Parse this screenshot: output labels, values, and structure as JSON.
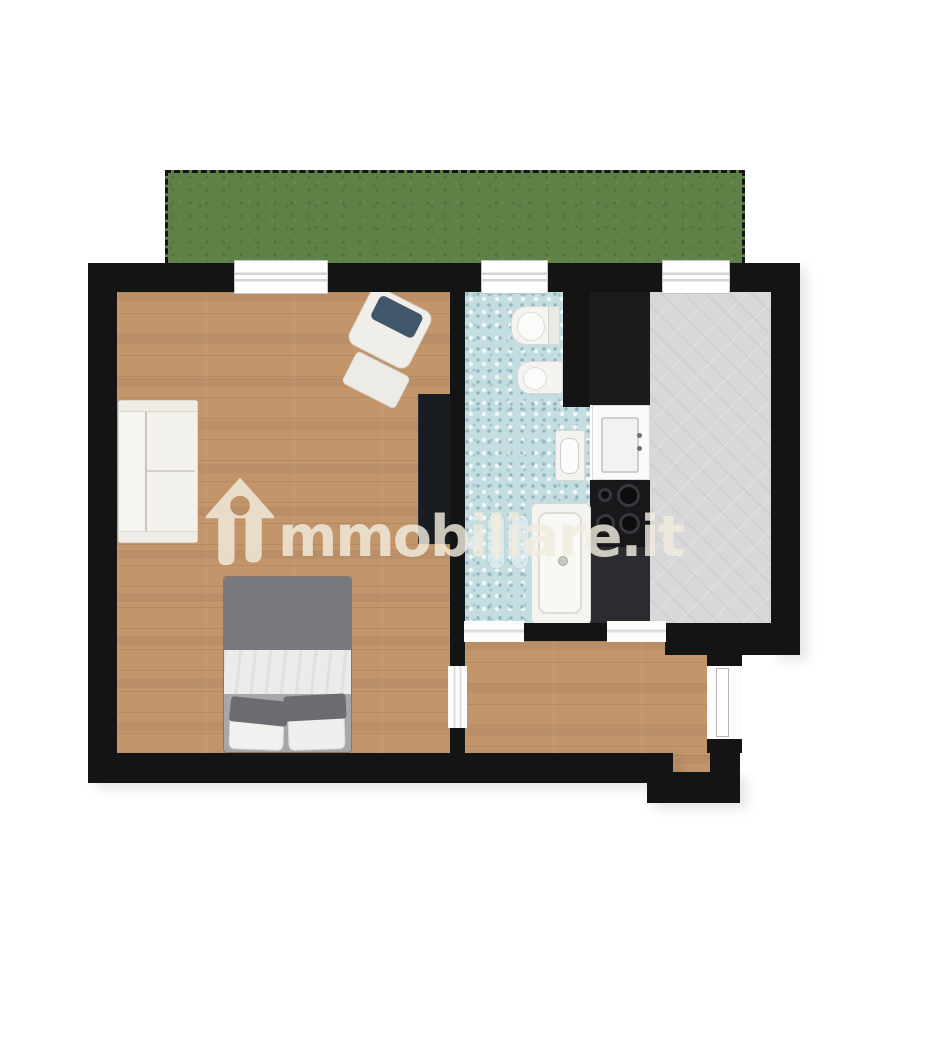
{
  "image_type": "2d-rendered-floor-plan",
  "watermark": {
    "text": "immobiliare.it",
    "text_after_logo": "mmobiliare.it",
    "logo": "house-arrow-logo",
    "color": "#f1ecde"
  },
  "palette": {
    "background": "#ffffff",
    "walls": "#141414",
    "wood_floor": "#c2956b",
    "bathroom_tile": "#c4dde1",
    "kitchen_floor": "#d8d8d8",
    "garden_green": "#5e8148",
    "counter_dark": "#1b1b1e",
    "fixture_white": "#f4f3f0",
    "bed_duvet_gray": "#797a7f",
    "armchair_cushion_blue": "#42566b"
  },
  "rooms": [
    {
      "name": "garden-terrace",
      "finish": "grass",
      "border": "dashed"
    },
    {
      "name": "living-bedroom",
      "finish": "wood",
      "furniture": [
        "sofa",
        "armchair",
        "ottoman",
        "double-bed",
        "wardrobe"
      ]
    },
    {
      "name": "bathroom",
      "finish": "blue-mosaic-tile",
      "fixtures": [
        "toilet",
        "bidet",
        "washbasin",
        "bathtub",
        "radiator"
      ]
    },
    {
      "name": "kitchen",
      "finish": "gray-screed",
      "fixtures": [
        "tall-cabinet",
        "kitchen-sink",
        "cooktop-4-burners",
        "counter"
      ]
    },
    {
      "name": "hallway-entrance",
      "finish": "wood"
    }
  ],
  "openings": {
    "windows_on_top_wall": 3,
    "interior_door_openings": 3,
    "entry_door": 1
  }
}
